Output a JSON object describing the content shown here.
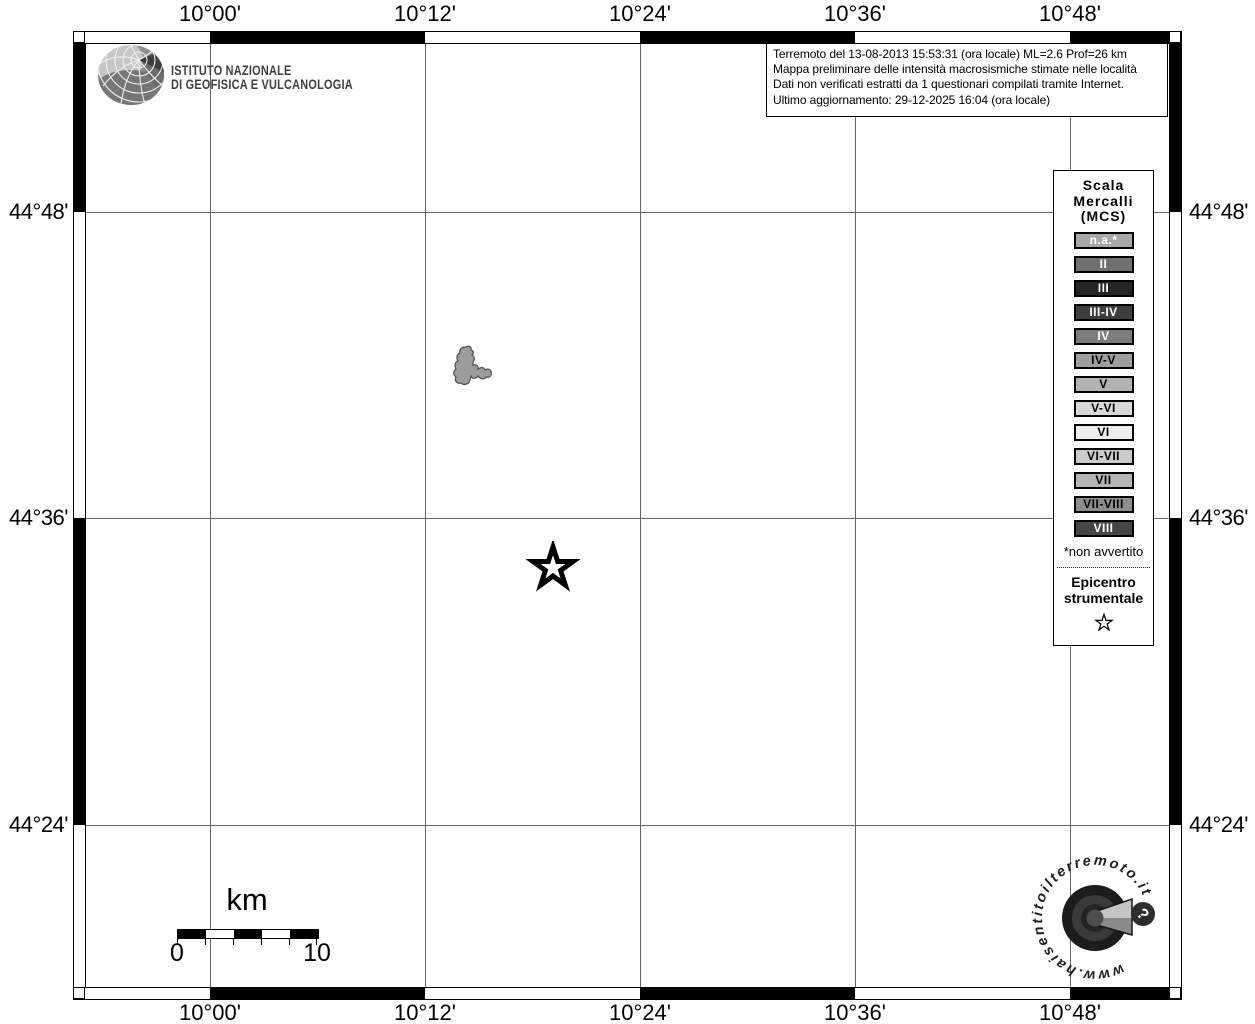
{
  "map_frame": {
    "lon_labels": [
      "10°00'",
      "10°12'",
      "10°24'",
      "10°36'",
      "10°48'"
    ],
    "lat_labels": [
      "44°48'",
      "44°36'",
      "44°24'"
    ]
  },
  "ingv_logo": {
    "line1": "ISTITUTO NAZIONALE",
    "line2": "DI GEOFISICA E VULCANOLOGIA"
  },
  "info_box": {
    "line1": "Terremoto del 13-08-2013 15:53:31 (ora locale) ML=2.6 Prof=26 km",
    "line2": "Mappa preliminare delle intensità macrosismiche stimate nelle località",
    "line3": "Dati non verificati estratti da 1 questionari compilati tramite Internet.",
    "line4": "Ultimo aggiornamento: 29-12-2025 16:04 (ora locale)"
  },
  "legend": {
    "title_line1": "Scala",
    "title_line2": "Mercalli",
    "title_line3": "(MCS)",
    "items": [
      {
        "label": "n.a.*",
        "bg": "#a8a8a8",
        "fg": "#ffffff"
      },
      {
        "label": "II",
        "bg": "#6f6f6f",
        "fg": "#ffffff"
      },
      {
        "label": "III",
        "bg": "#252525",
        "fg": "#ffffff"
      },
      {
        "label": "III-IV",
        "bg": "#3e3e3e",
        "fg": "#ffffff"
      },
      {
        "label": "IV",
        "bg": "#7d7d7d",
        "fg": "#ffffff"
      },
      {
        "label": "IV-V",
        "bg": "#9e9e9e",
        "fg": "#000000"
      },
      {
        "label": "V",
        "bg": "#b2b2b2",
        "fg": "#000000"
      },
      {
        "label": "V-VI",
        "bg": "#d8d8d8",
        "fg": "#000000"
      },
      {
        "label": "VI",
        "bg": "#ededed",
        "fg": "#000000"
      },
      {
        "label": "VI-VII",
        "bg": "#cbcbcb",
        "fg": "#000000"
      },
      {
        "label": "VII",
        "bg": "#b4b4b4",
        "fg": "#000000"
      },
      {
        "label": "VII-VIII",
        "bg": "#8d8d8d",
        "fg": "#000000"
      },
      {
        "label": "VIII",
        "bg": "#454545",
        "fg": "#ffffff"
      }
    ],
    "footnote": "*non avvertito",
    "epicenter_line1": "Epicentro",
    "epicenter_line2": "strumentale"
  },
  "scale_bar": {
    "unit": "km",
    "start_label": "0",
    "end_label": "10"
  },
  "watermark": {
    "circular_text": "www.haisentitoilterremoto.it",
    "badge": "?"
  },
  "map": {
    "locality_fill": "#9c9c9c"
  }
}
